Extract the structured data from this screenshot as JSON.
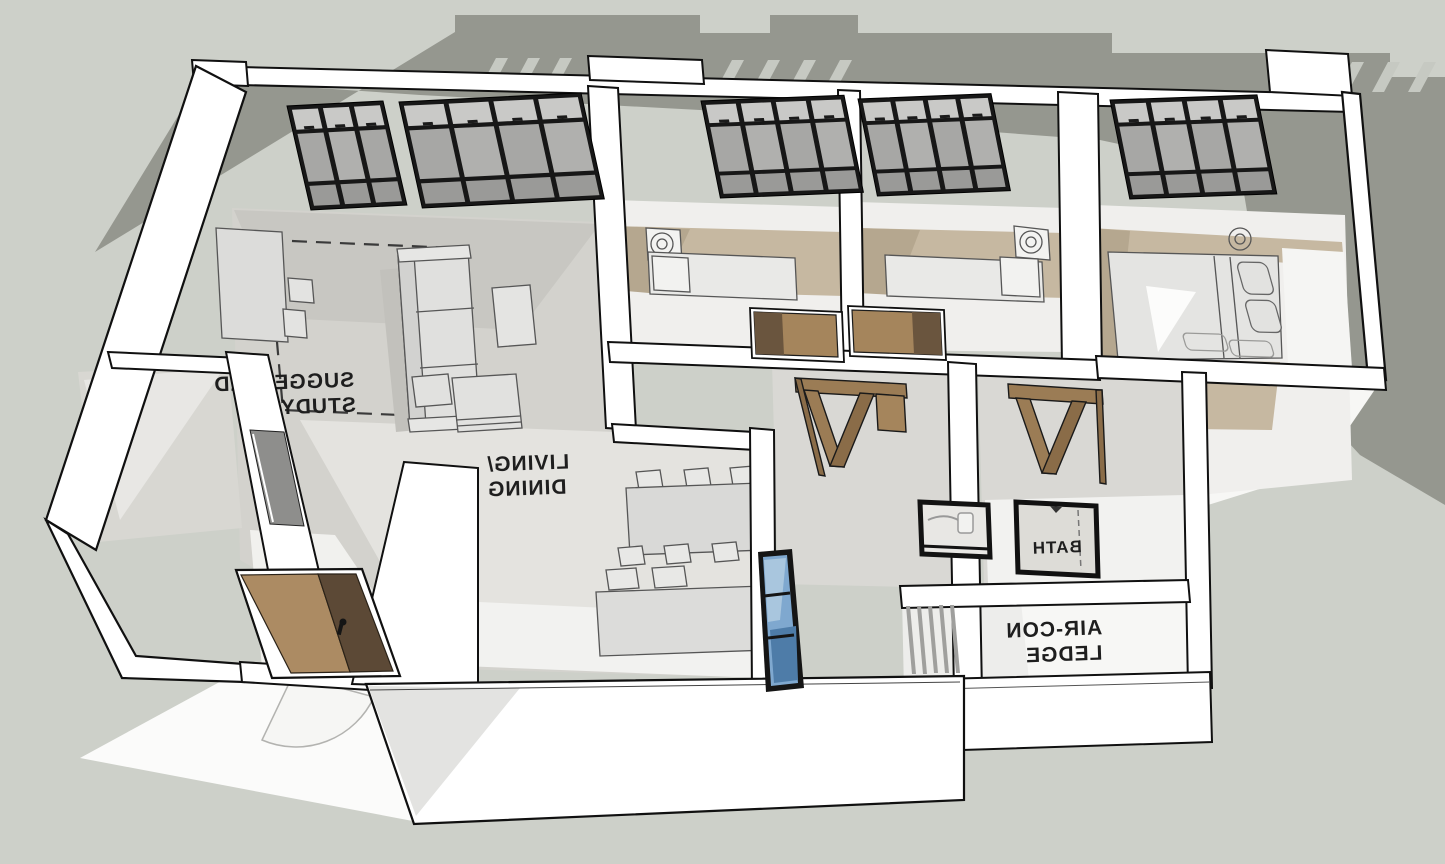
{
  "labels": {
    "study_line1": "SUGGESTED",
    "study_line2": "STUDY",
    "living_line1": "LIVING/",
    "living_line2": "DINING",
    "bath": "BATH",
    "aircon_line1": "AIR-CON",
    "aircon_line2": "LEDGE"
  },
  "colors": {
    "background": "#cdd0c9",
    "shadow": "#95978f",
    "wall": "#ffffff",
    "outline": "#101010",
    "floor_mid": "#d3d2cd",
    "floor_lit": "#e4e3df",
    "floor_bright": "#f3f3f0",
    "carpet": "#c6b8a1",
    "carpet_shade": "#b5a78f",
    "wood_light": "#ac8b63",
    "wood_mid": "#9b7c55",
    "wood_dark": "#5c4936",
    "window_frame": "#171717",
    "glass_light": "#c9c9c7",
    "glass_mid": "#a7a7a5",
    "glass_blue": "#7fa8cf",
    "furniture": "#dcdcda",
    "label_text": "#1e1e1e"
  }
}
